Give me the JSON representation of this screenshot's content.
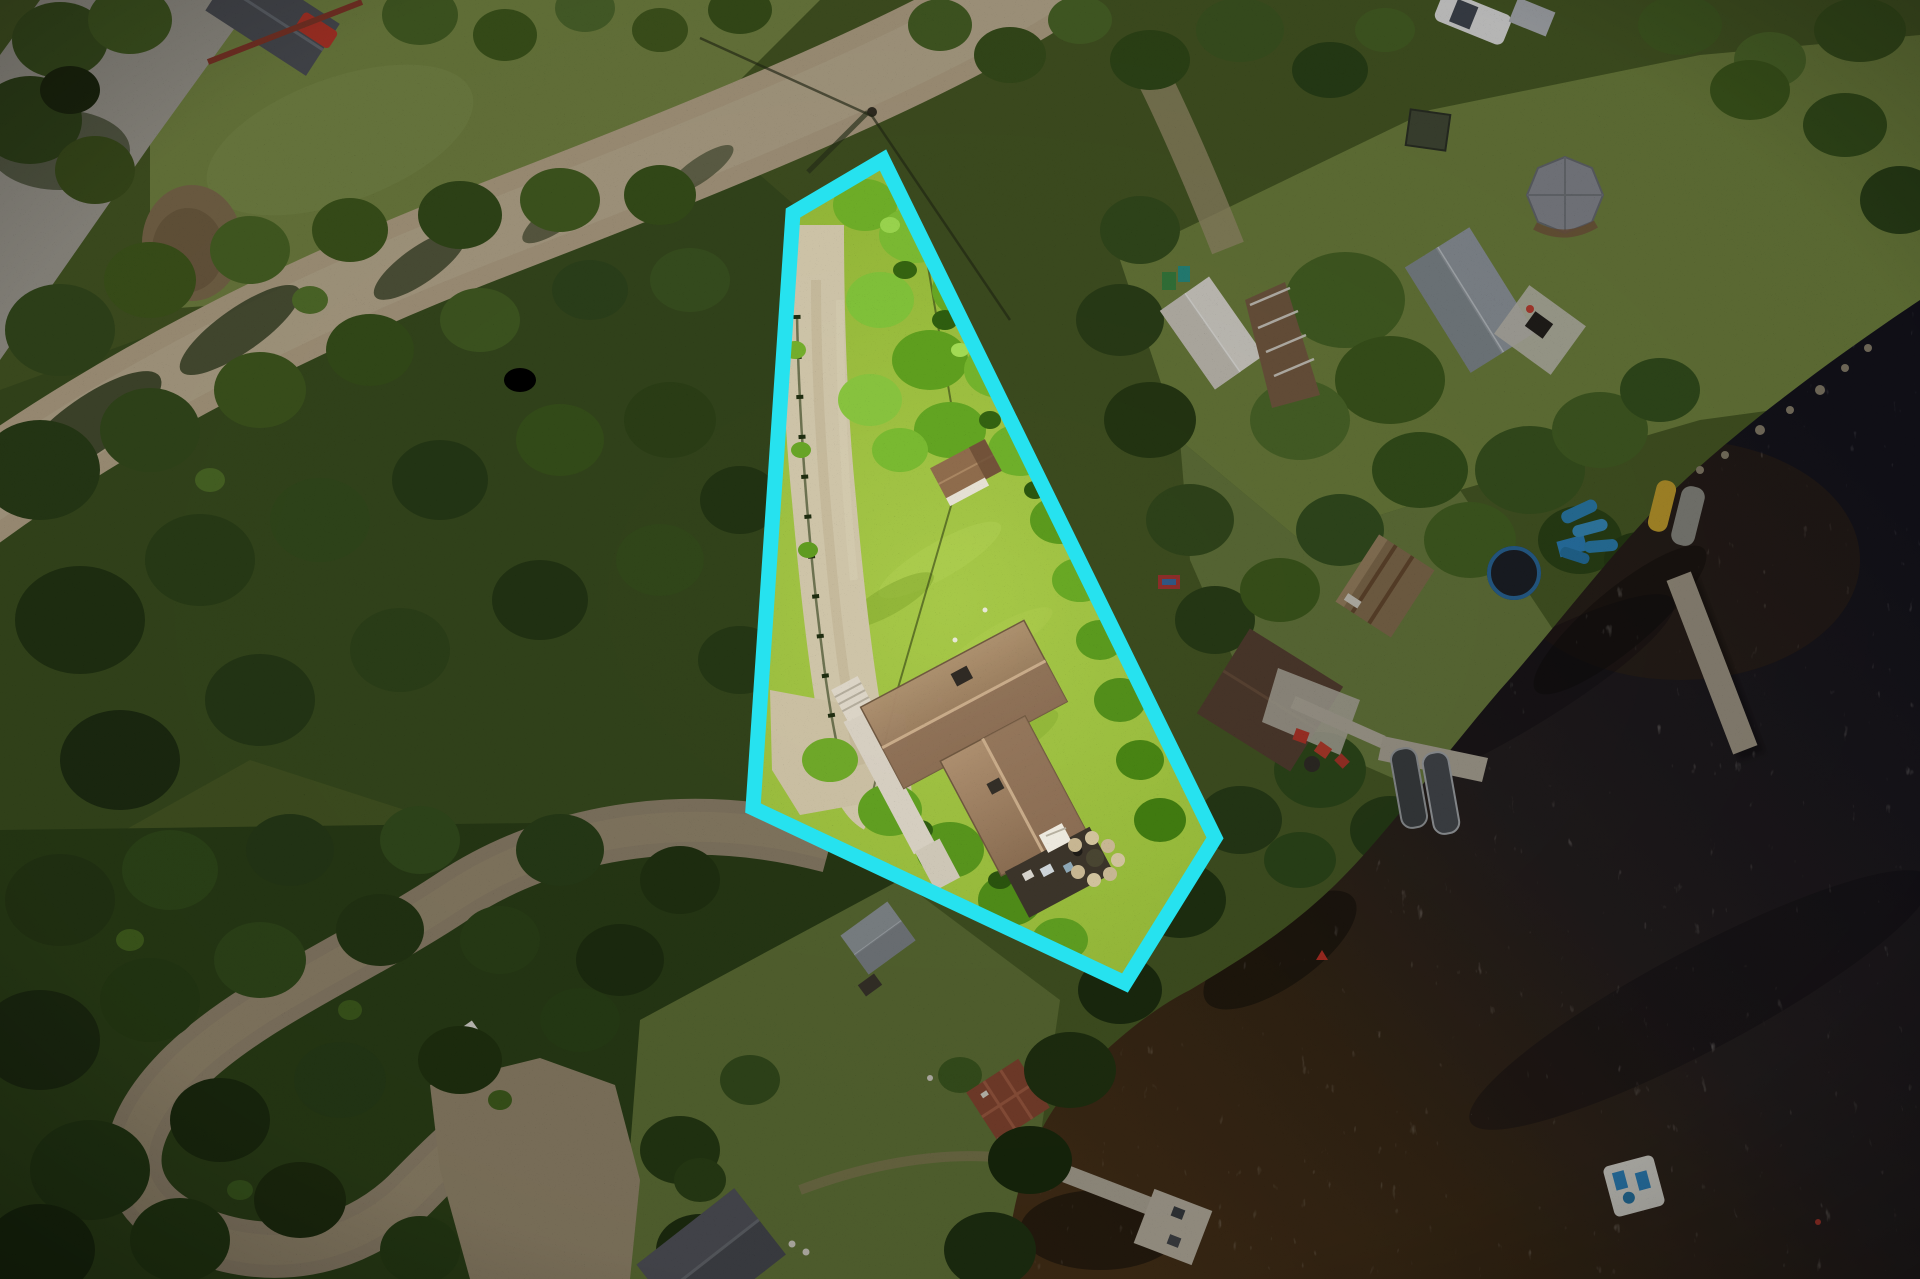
{
  "meta": {
    "title": "Aerial drone photo of lakefront lot with highlighted property boundary"
  },
  "boundary": {
    "color": "#26E2EF",
    "stroke_width": "15",
    "points": "883,160 1215,838 1125,983 753,808 793,213",
    "dim_path": "M0 0 H1920 V1279 H0 Z M883 160 L1215 838 L1125 983 L753 808 L793 213 Z",
    "dim_opacity": "0.22"
  },
  "highlighted_lot": {
    "fill": "#9CC13F",
    "features": [
      "tree-canopy",
      "gravel-driveway",
      "split-rail-fence",
      "cottage-brown-roof",
      "wood-deck-and-stairs",
      "rear-dark-patio",
      "stone-garden",
      "small-brown-shed",
      "utility-wire"
    ]
  },
  "scene": {
    "north": [
      "gravel-road",
      "utility-pole-with-wires",
      "gray-gravel-driveway",
      "neighbor-house-dark-roof",
      "red-car",
      "dirt-mound",
      "tree-line"
    ],
    "east": [
      "white-roof-house",
      "gray-roof-house",
      "octagonal-gazebo",
      "white-car",
      "storage-shed",
      "trampoline",
      "rusty-waterfront-shed",
      "brown-roof-house",
      "stone-patio",
      "red-chairs",
      "boardwalk",
      "boat-dock",
      "two-moored-boats",
      "blue-kayaks",
      "yellow-boat",
      "lake-dock",
      "swim-raft",
      "mooring-buoy"
    ],
    "south": [
      "winding-dirt-road",
      "gravel-parking-pad",
      "white-utility-trailer",
      "gray-roof-shed",
      "garden-plot",
      "l-shaped-dock",
      "lakeside-house-roof",
      "footpath"
    ],
    "west": [
      "dense-forest"
    ],
    "water": [
      "dark-lake-surface",
      "sun-glitter"
    ]
  },
  "palette": {
    "boundary_cyan": "#26E2EF",
    "highlight_grass": "#9CC13F",
    "canopy_green": "#74B02A",
    "driveway_gravel": "#CFC5A9",
    "roof_brown": "#A4866A",
    "road_tan": "#C4B394",
    "forest_dark": "#2F4419",
    "lake_dark": "#15141E",
    "lake_brown": "#4A3319"
  }
}
